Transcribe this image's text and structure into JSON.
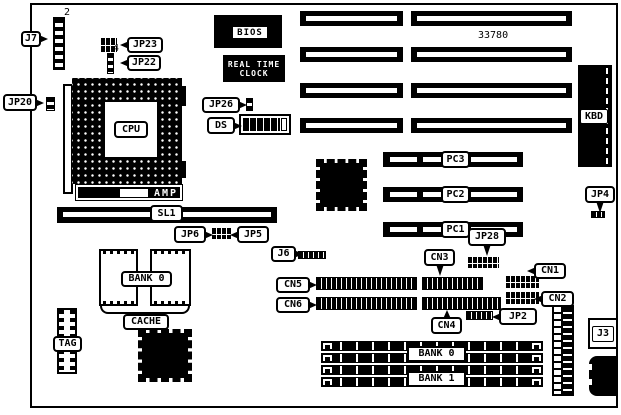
{
  "colors": {
    "ink": "#000000",
    "paper": "#ffffff"
  },
  "board": {
    "part_number": "33780",
    "chips": {
      "bios": "BIOS",
      "rtc_line1": "REAL TIME",
      "rtc_line2": "CLOCK",
      "cpu": "CPU",
      "amp": "AMP"
    },
    "slots": {
      "sl1": "SL1",
      "pc1": "PC1",
      "pc2": "PC2",
      "pc3": "PC3",
      "kbd": "KBD",
      "simm_bank0": "BANK 0",
      "simm_bank1": "BANK 1"
    },
    "cache": {
      "bank": "BANK 0",
      "cache": "CACHE",
      "tag": "TAG"
    },
    "jumpers": {
      "jp2": "JP2",
      "jp4": "JP4",
      "jp5": "JP5",
      "jp6": "JP6",
      "jp20": "JP20",
      "jp22": "JP22",
      "jp23": "JP23",
      "jp26": "JP26",
      "jp28": "JP28"
    },
    "connectors": {
      "j3": "J3",
      "j6": "J6",
      "j7": "J7",
      "cn1": "CN1",
      "cn2": "CN2",
      "cn3": "CN3",
      "cn4": "CN4",
      "cn5": "CN5",
      "cn6": "CN6",
      "ds": "DS"
    },
    "pin_numbers": {
      "j7_pin": "2",
      "jp23_pin": "4"
    }
  }
}
